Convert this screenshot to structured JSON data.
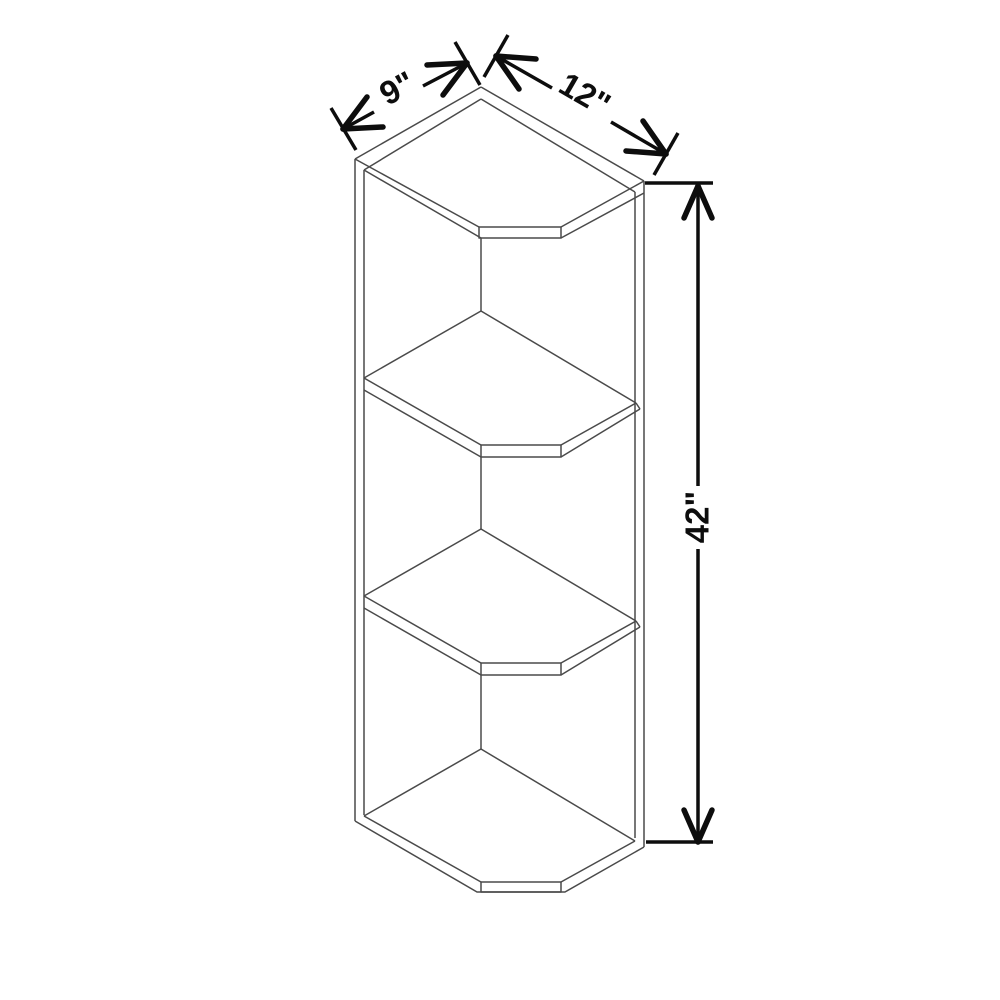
{
  "drawing": {
    "title": "corner open-end wall shelf cabinet line drawing",
    "shelf_count": 4,
    "dimensions": {
      "depth_label": "9\"",
      "width_label": "12\"",
      "height_label": "42\"",
      "depth_in": 9,
      "width_in": 12,
      "height_in": 42
    },
    "colors": {
      "background": "#ffffff",
      "cabinet_outline": "#4a4a4a",
      "dimension_ink": "#0d0d0d"
    }
  }
}
